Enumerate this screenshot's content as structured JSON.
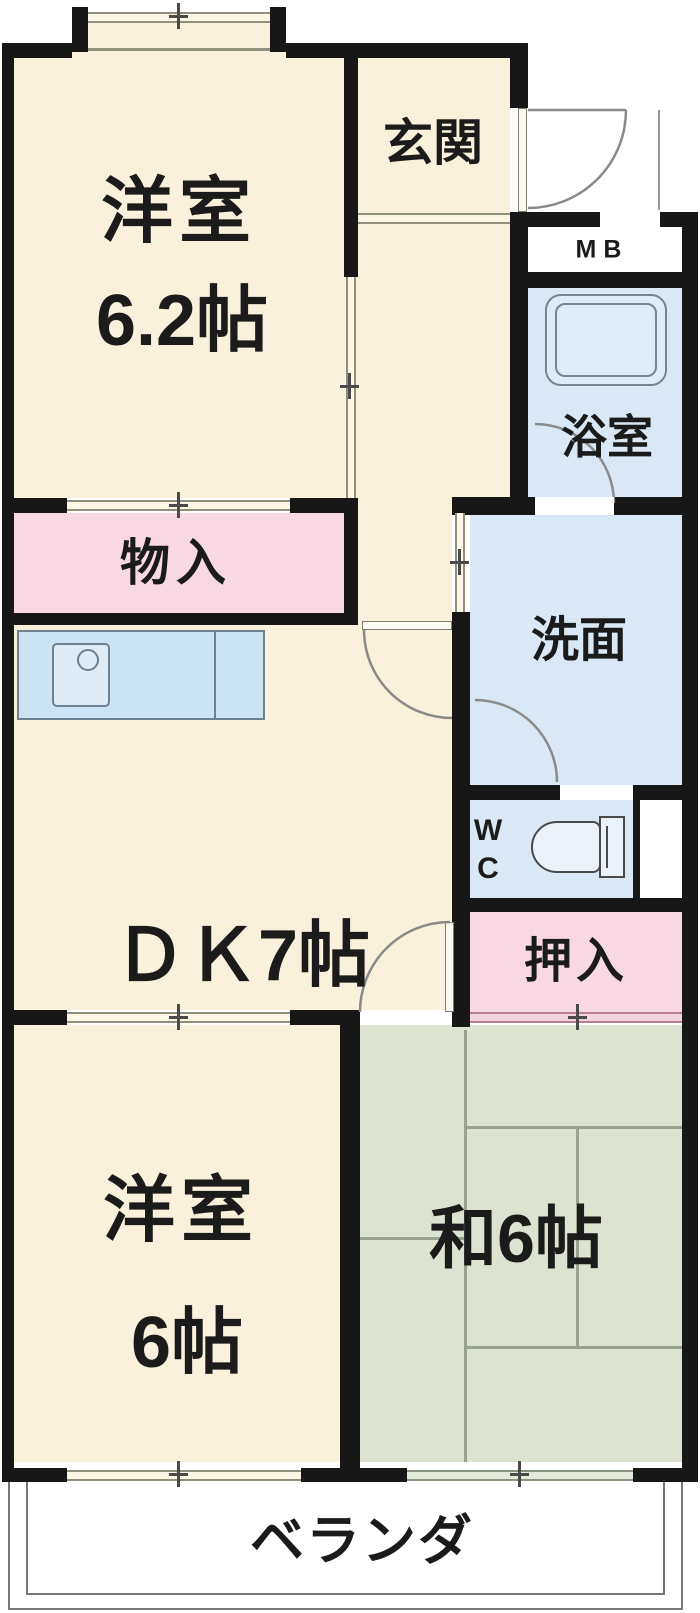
{
  "rooms": {
    "western_room_top": {
      "name_label": "洋室",
      "size_label": "6.2帖"
    },
    "entrance": {
      "label": "玄関"
    },
    "meter_box": {
      "label": "MB"
    },
    "bathroom": {
      "label": "浴室"
    },
    "storage": {
      "label": "物入"
    },
    "washroom": {
      "label": "洗面"
    },
    "dining_kitchen": {
      "label": "ＤＫ7帖"
    },
    "toilet": {
      "label_w": "W",
      "label_c": "C"
    },
    "closet": {
      "label": "押入"
    },
    "western_room_bottom": {
      "name_label": "洋室",
      "size_label": "6帖"
    },
    "japanese_room": {
      "label": "和6帖"
    },
    "veranda": {
      "label": "ベランダ"
    }
  },
  "colors": {
    "wall": "#171717",
    "room_cream": "#F9F1DB",
    "closet_pink": "#F8D8E2",
    "wet_area_blue": "#D9E8F4",
    "tatami_green": "#DCE3D1",
    "fixture_blue": "#CBE3F3",
    "text": "#1B1B1B"
  }
}
